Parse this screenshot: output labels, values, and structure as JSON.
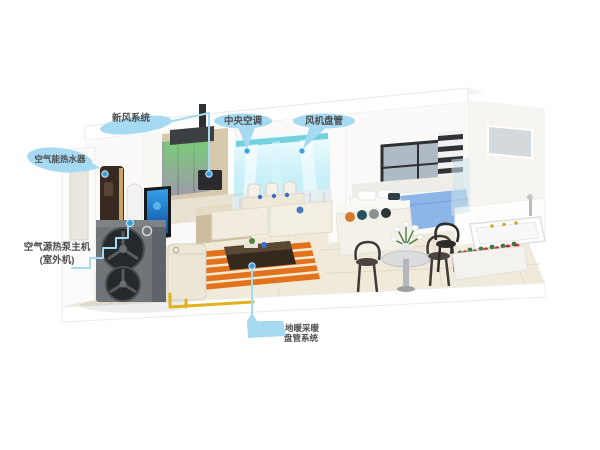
{
  "diagram": {
    "type": "air-source heat pump whole-home system cutaway illustration",
    "labels": {
      "fresh_air": {
        "text": "新风系统"
      },
      "central_ac": {
        "text": "中央空调"
      },
      "fan_coil": {
        "text": "风机盘管"
      },
      "hot_water": {
        "text": "空气能热水器"
      },
      "heat_pump": {
        "line1": "空气源热泵主机",
        "line2": "(室外机)"
      },
      "floor_heating": {
        "line1": "地暖采暖",
        "line2": "盘管系统"
      }
    },
    "colors": {
      "label_bubble": "#a6d9f2",
      "label_text": "#4d4d4d",
      "pointer_dot": "#3f9fdc",
      "airflow_green": "#6fdc66",
      "airflow_cyan": "#8fdff2",
      "pipe_yellow": "#dfb31d",
      "rug_orange": "#e2731c",
      "blanket_blue": "#8cb6e8",
      "outdoor_unit_gray": "#70757a",
      "water_heater_brown": "#382a20",
      "flower_red": "#c22b35"
    }
  }
}
